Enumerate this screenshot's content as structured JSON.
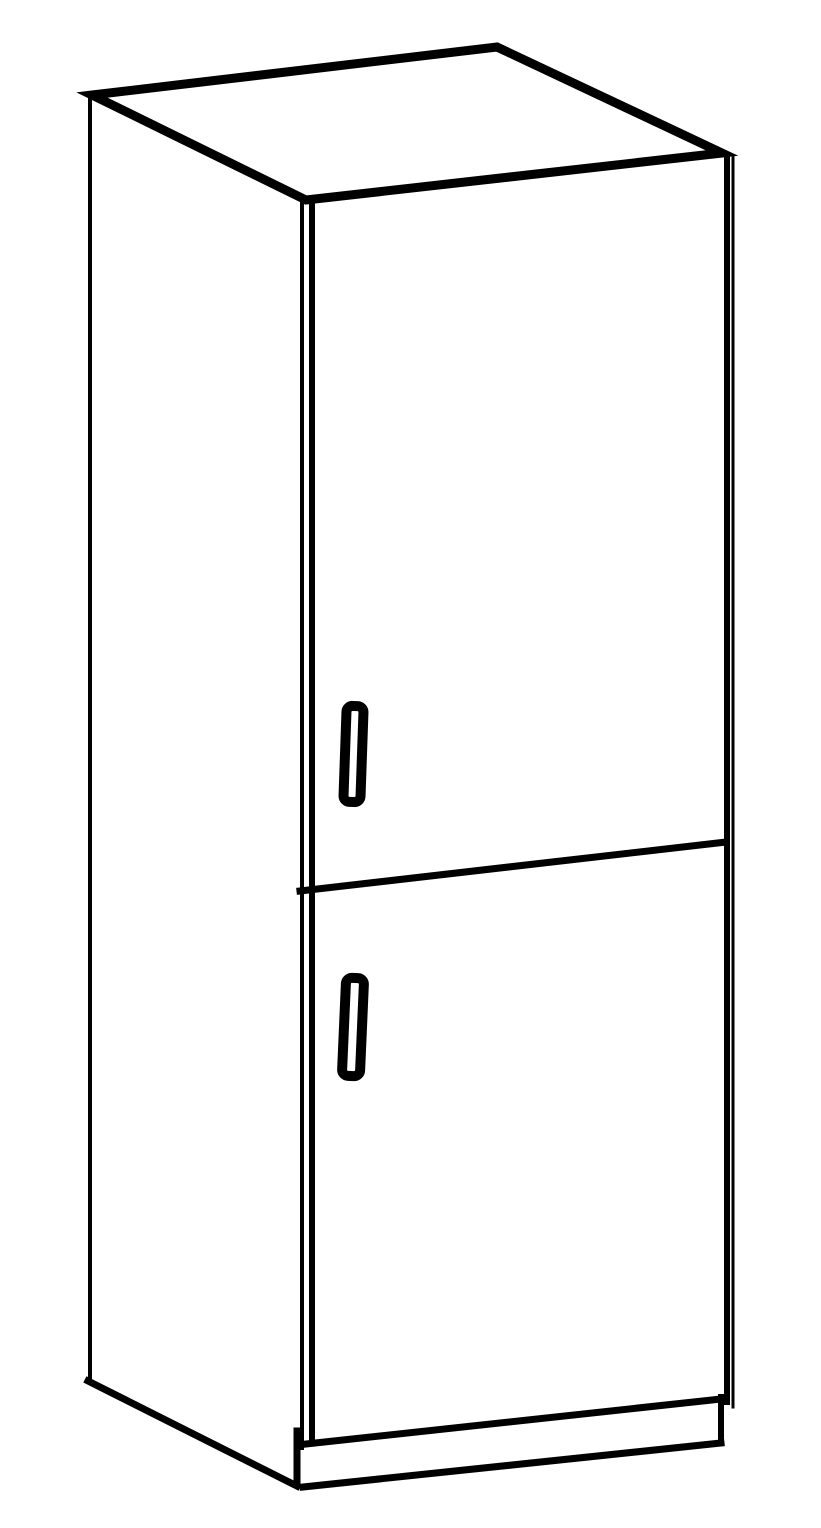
{
  "meta": {
    "subject": "tall-two-door-cabinet-line-drawing",
    "background_color": "#ffffff",
    "line_color": "#000000"
  },
  "drawing": {
    "viewbox": "0 0 821 1528",
    "shapes": [
      {
        "name": "cabinet-top-face",
        "type": "polygon",
        "points": [
          [
            92,
            95
          ],
          [
            497,
            47
          ],
          [
            722,
            153
          ],
          [
            306,
            200
          ]
        ],
        "stroke_width": 9,
        "fill": "#ffffff"
      },
      {
        "name": "left-side-edge",
        "type": "line",
        "x1": 90,
        "y1": 96,
        "x2": 90,
        "y2": 1383,
        "stroke_width": 4
      },
      {
        "name": "left-side-bottom-edge",
        "type": "line",
        "x1": 88,
        "y1": 1381,
        "x2": 297,
        "y2": 1486,
        "stroke_width": 7
      },
      {
        "name": "carcass-front-left-edge",
        "type": "line",
        "x1": 302,
        "y1": 199,
        "x2": 302,
        "y2": 1448,
        "stroke_width": 4
      },
      {
        "name": "door-left-edge",
        "type": "line",
        "x1": 312,
        "y1": 205,
        "x2": 312,
        "y2": 1442,
        "stroke_width": 6
      },
      {
        "name": "door-right-edge",
        "type": "line",
        "x1": 727,
        "y1": 159,
        "x2": 727,
        "y2": 1402,
        "stroke_width": 6
      },
      {
        "name": "carcass-right-edge",
        "type": "line",
        "x1": 733,
        "y1": 156,
        "x2": 733,
        "y2": 1407,
        "stroke_width": 3
      },
      {
        "name": "door-divider-edge",
        "type": "line",
        "x1": 300,
        "y1": 891,
        "x2": 726,
        "y2": 842,
        "stroke_width": 7
      },
      {
        "name": "plinth-top-edge",
        "type": "line",
        "x1": 306,
        "y1": 1444,
        "x2": 721,
        "y2": 1399,
        "stroke_width": 7
      },
      {
        "name": "plinth-right-edge",
        "type": "line",
        "x1": 721,
        "y1": 1397,
        "x2": 721,
        "y2": 1443,
        "stroke_width": 6
      },
      {
        "name": "plinth-bottom-edge",
        "type": "line",
        "x1": 303,
        "y1": 1487,
        "x2": 721,
        "y2": 1443,
        "stroke_width": 7
      },
      {
        "name": "plinth-left-cap",
        "type": "line",
        "x1": 297,
        "y1": 1431,
        "x2": 297,
        "y2": 1484,
        "stroke_width": 7
      },
      {
        "name": "upper-door-handle",
        "type": "rect",
        "x": 345,
        "y": 706,
        "width": 17,
        "height": 96,
        "rx": 6,
        "stroke_width": 10,
        "fill": "#ffffff",
        "rotate": 2
      },
      {
        "name": "lower-door-handle",
        "type": "rect",
        "x": 344,
        "y": 978,
        "width": 18,
        "height": 98,
        "rx": 6,
        "stroke_width": 10,
        "fill": "#ffffff",
        "rotate": 2.5
      }
    ]
  }
}
